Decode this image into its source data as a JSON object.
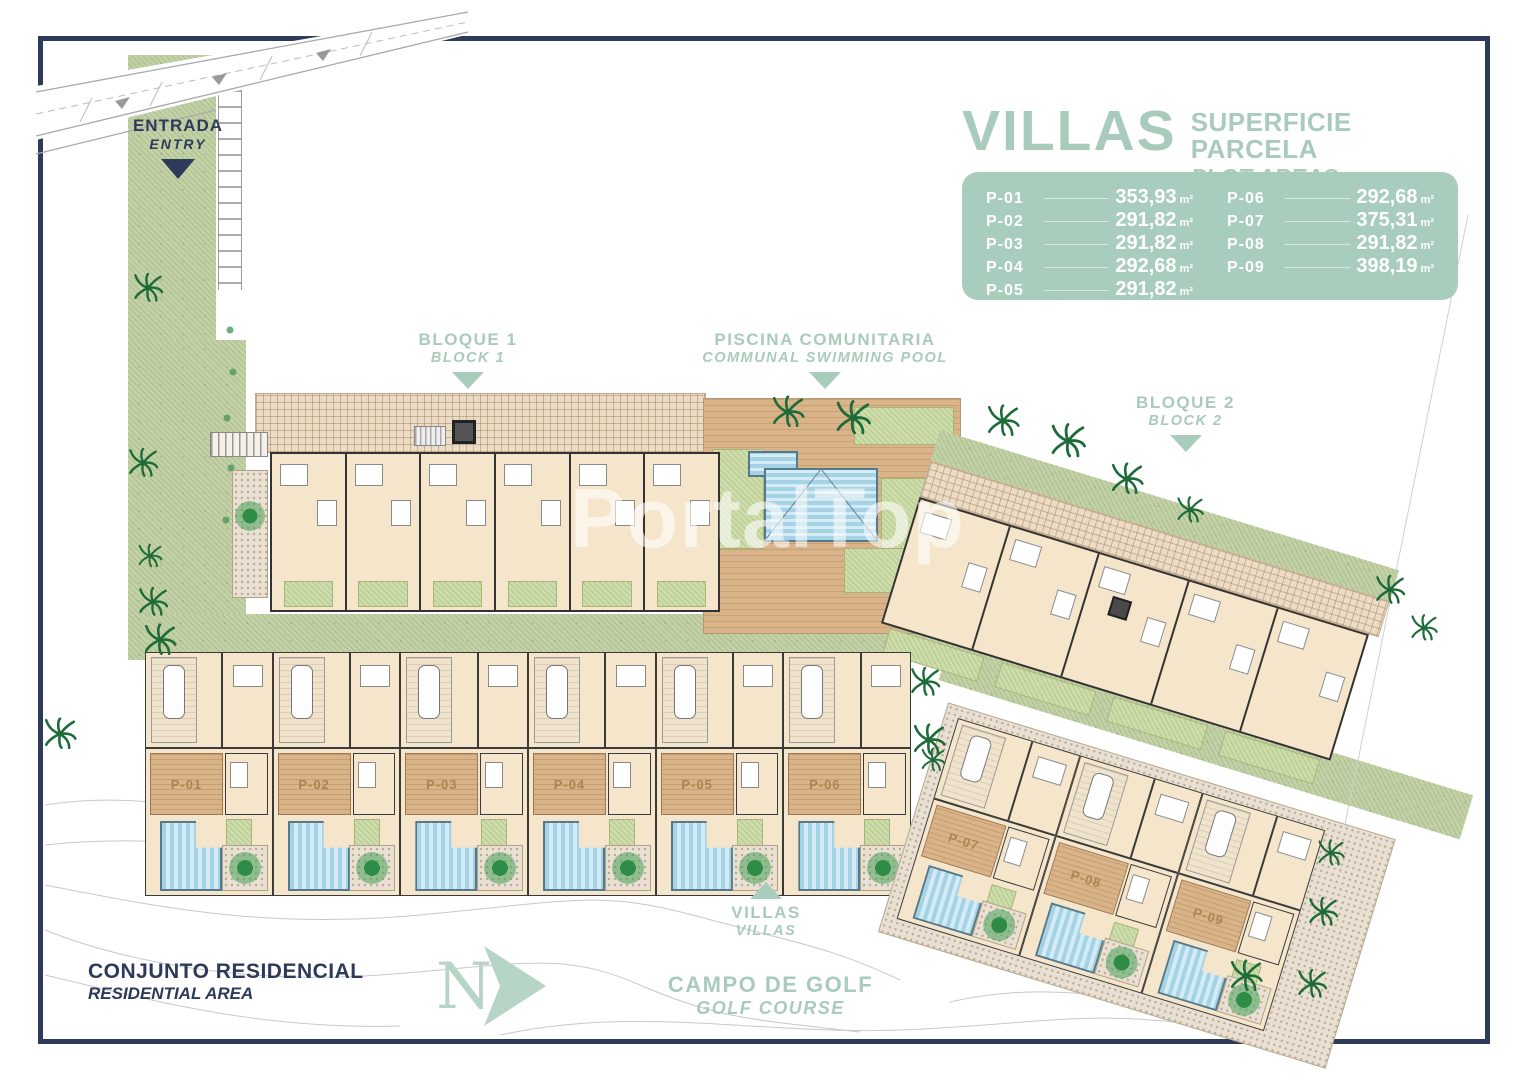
{
  "watermark": "PortalTop",
  "legend": {
    "title": "VILLAS",
    "subtitle": "SUPERFICIE PARCELA",
    "subtitle_en": "PLOT AREAS",
    "plots": [
      {
        "id": "P-01",
        "area": "353,93",
        "unit": "m²"
      },
      {
        "id": "P-02",
        "area": "291,82",
        "unit": "m²"
      },
      {
        "id": "P-03",
        "area": "291,82",
        "unit": "m²"
      },
      {
        "id": "P-04",
        "area": "292,68",
        "unit": "m²"
      },
      {
        "id": "P-05",
        "area": "291,82",
        "unit": "m²"
      },
      {
        "id": "P-06",
        "area": "292,68",
        "unit": "m²"
      },
      {
        "id": "P-07",
        "area": "375,31",
        "unit": "m²"
      },
      {
        "id": "P-08",
        "area": "291,82",
        "unit": "m²"
      },
      {
        "id": "P-09",
        "area": "398,19",
        "unit": "m²"
      }
    ]
  },
  "annotations": {
    "entrance": {
      "es": "ENTRADA",
      "en": "ENTRY"
    },
    "block1": {
      "es": "BLOQUE 1",
      "en": "BLOCK 1"
    },
    "communal_pool": {
      "es": "PISCINA COMUNITARIA",
      "en": "COMMUNAL SWIMMING POOL"
    },
    "block2": {
      "es": "BLOQUE 2",
      "en": "BLOCK 2"
    },
    "villas": {
      "es": "VILLAS",
      "en": "VILLAS"
    },
    "residential": {
      "es": "CONJUNTO RESIDENCIAL",
      "en": "RESIDENTIAL AREA"
    },
    "golf": {
      "es": "CAMPO DE GOLF",
      "en": "GOLF COURSE"
    },
    "north": "N"
  },
  "villas": {
    "row": [
      "P-01",
      "P-02",
      "P-03",
      "P-04",
      "P-05",
      "P-06"
    ],
    "diagonal": [
      "P-07",
      "P-08",
      "P-09"
    ]
  },
  "colors": {
    "navy": "#2e3a59",
    "teal": "#a9cbbc",
    "panel": "#a9cdbd",
    "pool_blue": "#a6d2e5",
    "deck_tan": "#cfa377",
    "lawn_green": "#ccdba2",
    "path_green": "#c3d2a6"
  }
}
